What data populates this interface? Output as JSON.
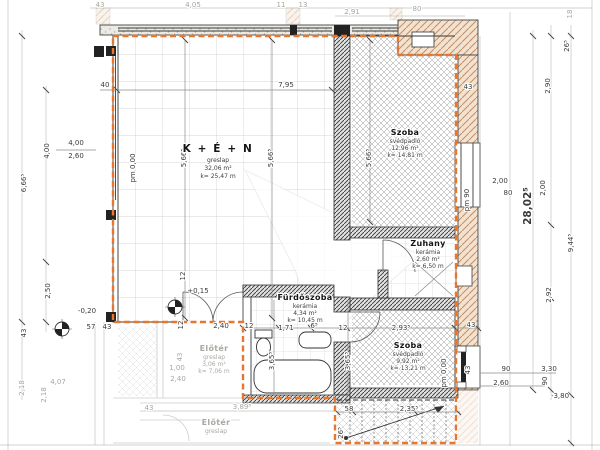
{
  "drawing": {
    "type": "architectural-floor-plan",
    "colors": {
      "envelope_orange": "#e8762c",
      "highlight_magenta": "#c427c4",
      "wall_tan": "#f3e2cf"
    },
    "rooms": [
      {
        "name": "K + É + N",
        "floor": "greslap",
        "area": "32,06 m²",
        "perimeter": "k= 25,47 m",
        "x": 218,
        "y": 152,
        "big": true,
        "faint": false
      },
      {
        "name": "Szoba",
        "floor": "svédpadló",
        "area": "12,96 m²",
        "perimeter": "k= 14,81 m",
        "x": 405,
        "y": 135,
        "big": false,
        "faint": false
      },
      {
        "name": "Zuhany",
        "floor": "kerámia",
        "area": "2,60 m²",
        "perimeter": "k= 6,50 m",
        "x": 428,
        "y": 246,
        "big": false,
        "faint": false
      },
      {
        "name": "Fürdőszoba",
        "floor": "kerámia",
        "area": "4,34 m²",
        "perimeter": "k= 10,45 m",
        "x": 305,
        "y": 300,
        "big": false,
        "faint": false
      },
      {
        "name": "Szoba",
        "floor": "svédpadló",
        "area": "9,92 m²",
        "perimeter": "k= 13,21 m",
        "x": 408,
        "y": 348,
        "big": false,
        "faint": false
      },
      {
        "name": "Előtér",
        "floor": "greslap",
        "area": "3,06 m²",
        "perimeter": "k= 7,06 m",
        "x": 214,
        "y": 351,
        "big": false,
        "faint": true
      },
      {
        "name": "Előtér",
        "floor": "greslap",
        "area": "",
        "perimeter": "",
        "x": 216,
        "y": 425,
        "big": false,
        "faint": true
      }
    ],
    "dim_labels": [
      {
        "t": "43",
        "x": 100,
        "y": 7,
        "r": 0,
        "c": "f"
      },
      {
        "t": "4,05",
        "x": 193,
        "y": 7,
        "r": 0,
        "c": "f"
      },
      {
        "t": "11",
        "x": 281,
        "y": 7,
        "r": 0,
        "c": "f"
      },
      {
        "t": "13",
        "x": 303,
        "y": 7,
        "r": 0,
        "c": "f"
      },
      {
        "t": "2,91",
        "x": 352,
        "y": 14,
        "r": 0,
        "c": "f"
      },
      {
        "t": "80",
        "x": 417,
        "y": 11,
        "r": 0,
        "c": "f"
      },
      {
        "t": "18",
        "x": 572,
        "y": 14,
        "r": -90,
        "c": "f"
      },
      {
        "t": "26⁵",
        "x": 569,
        "y": 46,
        "r": -90,
        "c": "d"
      },
      {
        "t": "43",
        "x": 468,
        "y": 89,
        "r": 0,
        "c": "d"
      },
      {
        "t": "2,90",
        "x": 550,
        "y": 86,
        "r": -90,
        "c": "d"
      },
      {
        "t": "40",
        "x": 105,
        "y": 87,
        "r": 0,
        "c": "d"
      },
      {
        "t": "7,95",
        "x": 286,
        "y": 87,
        "r": 0,
        "c": "d"
      },
      {
        "t": "5,66⁵",
        "x": 186,
        "y": 158,
        "r": -90,
        "c": "d"
      },
      {
        "t": "5,66⁵",
        "x": 273,
        "y": 158,
        "r": -90,
        "c": "d"
      },
      {
        "t": "5,66⁵",
        "x": 371,
        "y": 158,
        "r": -90,
        "c": "d"
      },
      {
        "t": "pm 0,00",
        "x": 135,
        "y": 168,
        "r": -90,
        "c": "d"
      },
      {
        "t": "pm 90",
        "x": 469,
        "y": 200,
        "r": -90,
        "c": "d"
      },
      {
        "t": "2,00",
        "x": 500,
        "y": 183,
        "r": 0,
        "c": "d"
      },
      {
        "t": "80",
        "x": 508,
        "y": 195,
        "r": 0,
        "c": "d"
      },
      {
        "t": "2,00",
        "x": 545,
        "y": 188,
        "r": -90,
        "c": "d"
      },
      {
        "t": "28,02⁵",
        "x": 531,
        "y": 206,
        "r": -90,
        "c": "m"
      },
      {
        "t": "9,44⁵",
        "x": 573,
        "y": 243,
        "r": -90,
        "c": "d"
      },
      {
        "t": "2,92",
        "x": 551,
        "y": 295,
        "r": -90,
        "c": "d"
      },
      {
        "t": "6,66⁵",
        "x": 26,
        "y": 183,
        "r": -90,
        "c": "d"
      },
      {
        "t": "4,00",
        "x": 49,
        "y": 151,
        "r": -90,
        "c": "d"
      },
      {
        "t": "4,00",
        "x": 76,
        "y": 145,
        "r": 0,
        "c": "d"
      },
      {
        "t": "2,60",
        "x": 76,
        "y": 158,
        "r": 0,
        "c": "d"
      },
      {
        "t": "2,50",
        "x": 50,
        "y": 291,
        "r": -90,
        "c": "d"
      },
      {
        "t": "43",
        "x": 26,
        "y": 333,
        "r": -90,
        "c": "d"
      },
      {
        "t": "-0,20",
        "x": 87,
        "y": 313,
        "r": 0,
        "c": "d"
      },
      {
        "t": "57",
        "x": 91,
        "y": 329,
        "r": 0,
        "c": "d"
      },
      {
        "t": "43",
        "x": 107,
        "y": 329,
        "r": 0,
        "c": "d"
      },
      {
        "t": "12",
        "x": 185,
        "y": 276,
        "r": -90,
        "c": "d"
      },
      {
        "t": "+0,15",
        "x": 198,
        "y": 293,
        "r": 0,
        "c": "d"
      },
      {
        "t": "12",
        "x": 183,
        "y": 325,
        "r": -90,
        "c": "d"
      },
      {
        "t": "2,40",
        "x": 221,
        "y": 328,
        "r": 0,
        "c": "d"
      },
      {
        "t": "12",
        "x": 249,
        "y": 328,
        "r": 0,
        "c": "d"
      },
      {
        "t": "1,71",
        "x": 286,
        "y": 330,
        "r": 0,
        "c": "d"
      },
      {
        "t": "6⁵",
        "x": 314,
        "y": 328,
        "r": 0,
        "c": "d"
      },
      {
        "t": "12",
        "x": 343,
        "y": 330,
        "r": 0,
        "c": "d"
      },
      {
        "t": "2,93⁵",
        "x": 401,
        "y": 330,
        "r": 0,
        "c": "d"
      },
      {
        "t": "43",
        "x": 471,
        "y": 327,
        "r": 0,
        "c": "d"
      },
      {
        "t": "3,65⁵",
        "x": 274,
        "y": 361,
        "r": -90,
        "c": "d"
      },
      {
        "t": "3,65⁵",
        "x": 350,
        "y": 361,
        "r": -90,
        "c": "d"
      },
      {
        "t": "43",
        "x": 470,
        "y": 370,
        "r": -90,
        "c": "d"
      },
      {
        "t": "pm 0,00",
        "x": 446,
        "y": 373,
        "r": -90,
        "c": "d"
      },
      {
        "t": "90",
        "x": 506,
        "y": 371,
        "r": 0,
        "c": "d"
      },
      {
        "t": "3,30",
        "x": 549,
        "y": 371,
        "r": 0,
        "c": "d"
      },
      {
        "t": "2,60",
        "x": 501,
        "y": 385,
        "r": 0,
        "c": "d"
      },
      {
        "t": "90",
        "x": 547,
        "y": 381,
        "r": -90,
        "c": "d"
      },
      {
        "t": "-3,80",
        "x": 560,
        "y": 398,
        "r": 0,
        "c": "d"
      },
      {
        "t": "58",
        "x": 349,
        "y": 411,
        "r": 0,
        "c": "d"
      },
      {
        "t": "2,35⁵",
        "x": 409,
        "y": 411,
        "r": 0,
        "c": "d"
      },
      {
        "t": "26⁵",
        "x": 343,
        "y": 433,
        "r": -90,
        "c": "d"
      },
      {
        "t": "43",
        "x": 149,
        "y": 410,
        "r": 0,
        "c": "f"
      },
      {
        "t": "3,89⁵",
        "x": 242,
        "y": 409,
        "r": 0,
        "c": "f"
      },
      {
        "t": "1,00",
        "x": 177,
        "y": 370,
        "r": 0,
        "c": "f"
      },
      {
        "t": "2,40",
        "x": 178,
        "y": 381,
        "r": 0,
        "c": "f"
      },
      {
        "t": "43",
        "x": 182,
        "y": 357,
        "r": -90,
        "c": "f"
      },
      {
        "t": "2,18",
        "x": 24,
        "y": 388,
        "r": -90,
        "c": "f"
      },
      {
        "t": "2,18",
        "x": 46,
        "y": 395,
        "r": -90,
        "c": "f"
      },
      {
        "t": "4,07",
        "x": 58,
        "y": 384,
        "r": 0,
        "c": "f"
      }
    ]
  }
}
